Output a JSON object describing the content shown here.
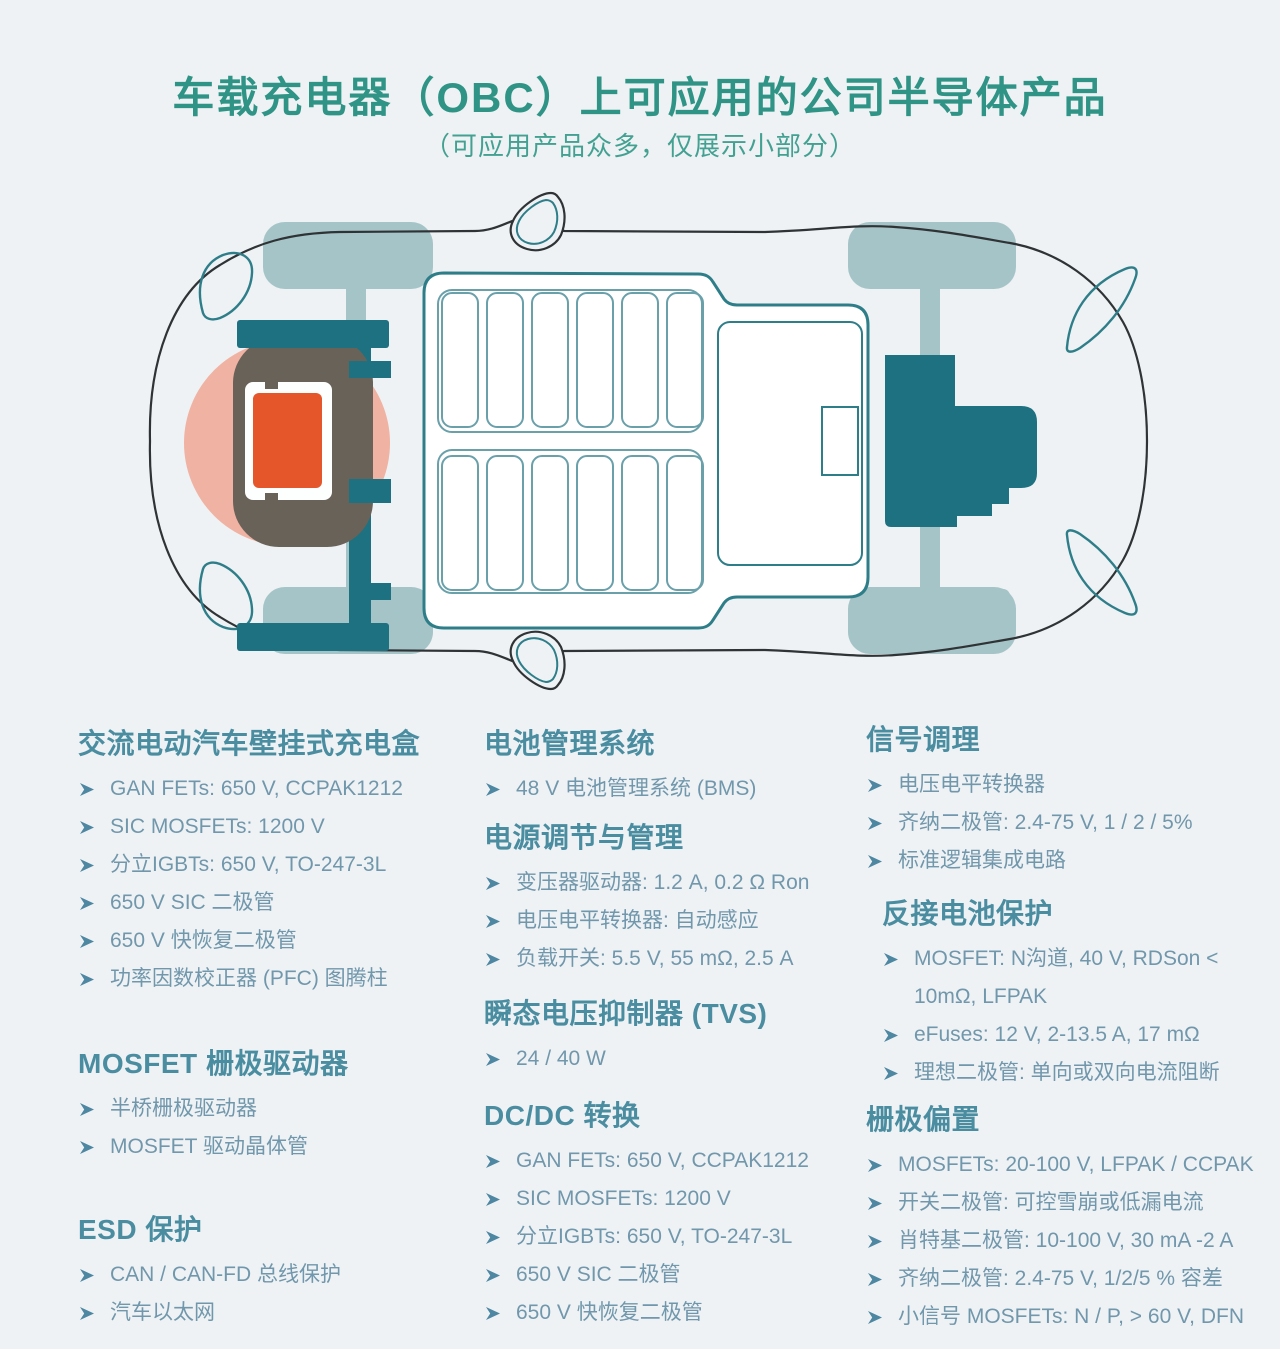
{
  "page": {
    "title": "车载充电器（OBC）上可应用的公司半导体产品",
    "subtitle": "（可应用产品众多，仅展示小部分）"
  },
  "diagram": {
    "type": "ev-top-view-illustration",
    "parts": [
      "car-body-outline",
      "front-left-wheel",
      "front-right-wheel",
      "rear-left-wheel",
      "rear-right-wheel",
      "left-axle",
      "right-axle",
      "side-mirror-top",
      "side-mirror-bottom",
      "rear-light-outlines",
      "headlight-outlines",
      "battery-pack",
      "battery-cells",
      "battery-side-compartment",
      "front-motor-unit",
      "obc-mount-frame",
      "obc-module-gray",
      "obc-package-white",
      "obc-die-orange",
      "obc-highlight-glow"
    ]
  },
  "bullet_icon": "arrowhead-right",
  "colors": {
    "background": "#eef2f4",
    "title": "#2f9486",
    "subtitle": "#43a192",
    "heading": "#4a8da1",
    "item_text": "#7197ac",
    "bullet": "#4d87a2",
    "teal_dark": "#1e7180",
    "teal_outline": "#2e7e89",
    "cell_outline": "#6aa0aa",
    "wheel_axle": "#a5c4c7",
    "obc_orange": "#e5562a",
    "glow_salmon": "#f0b2a2",
    "component_gray": "#696259",
    "body_line": "#2f3336"
  },
  "columns": [
    {
      "sections": [
        {
          "heading": "交流电动汽车壁挂式充电盒",
          "indent": false,
          "items": [
            "GAN FETs: 650 V, CCPAK1212",
            "SIC MOSFETs: 1200 V",
            "分立IGBTs: 650 V, TO-247-3L",
            "650 V SIC 二极管",
            "650 V 快恢复二极管",
            "功率因数校正器 (PFC) 图腾柱"
          ]
        },
        {
          "heading": "MOSFET 栅极驱动器",
          "indent": false,
          "items": [
            "半桥栅极驱动器",
            "MOSFET 驱动晶体管"
          ]
        },
        {
          "heading": "ESD 保护",
          "indent": false,
          "items": [
            "CAN / CAN-FD 总线保护",
            "汽车以太网"
          ]
        }
      ]
    },
    {
      "sections": [
        {
          "heading": "电池管理系统",
          "indent": false,
          "items": [
            "48 V 电池管理系统 (BMS)"
          ]
        },
        {
          "heading": "电源调节与管理",
          "indent": false,
          "items": [
            "变压器驱动器: 1.2 A, 0.2 Ω Ron",
            "电压电平转换器: 自动感应",
            "负载开关: 5.5 V, 55 mΩ, 2.5 A"
          ]
        },
        {
          "heading": "瞬态电压抑制器 (TVS)",
          "indent": false,
          "items": [
            "24 / 40 W"
          ]
        },
        {
          "heading": "DC/DC 转换",
          "indent": false,
          "items": [
            "GAN FETs: 650 V, CCPAK1212",
            "SIC MOSFETs: 1200 V",
            "分立IGBTs: 650 V, TO-247-3L",
            "650 V SIC 二极管",
            "650 V 快恢复二极管"
          ]
        }
      ]
    },
    {
      "sections": [
        {
          "heading": "信号调理",
          "indent": false,
          "items": [
            "电压电平转换器",
            "齐纳二极管: 2.4-75 V, 1 / 2 / 5%",
            "标准逻辑集成电路"
          ]
        },
        {
          "heading": "反接电池保护",
          "indent": true,
          "items": [
            "MOSFET: N沟道, 40 V, RDSon < 10mΩ, LFPAK",
            "eFuses: 12 V, 2-13.5 A, 17 mΩ",
            "理想二极管: 单向或双向电流阻断"
          ]
        },
        {
          "heading": "栅极偏置",
          "indent": false,
          "items": [
            "MOSFETs: 20-100 V, LFPAK / CCPAK",
            "开关二极管: 可控雪崩或低漏电流",
            "肖特基二极管: 10-100 V, 30 mA -2 A",
            "齐纳二极管: 2.4-75 V, 1/2/5 % 容差",
            "小信号 MOSFETs: N / P, > 60 V, DFN"
          ]
        }
      ]
    }
  ]
}
